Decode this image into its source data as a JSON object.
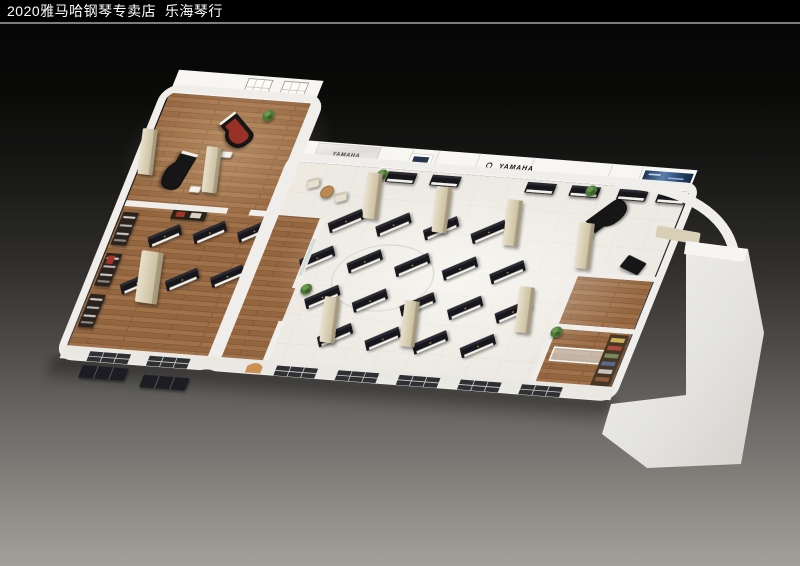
{
  "header": {
    "title": "2020雅马哈钢琴专卖店  乐海琴行"
  },
  "brand": {
    "wall_sign": "YAMAHA",
    "marble_sign": "YAMAHA"
  },
  "palette": {
    "titlebar_bg": "#000000",
    "titlebar_text": "#ffffff",
    "divider": "#7d7d7d",
    "bg_top": "#040404",
    "bg_bottom": "#a3a09b",
    "wall": "#efeeea",
    "wall_face": "#f7f6f3",
    "wood": "#9a6b42",
    "wood_dark": "#7a5433",
    "tile": "#edeae3",
    "piano_black": "#17171a",
    "keys_white": "#f2f1ea",
    "column_beige": "#d8cdb3",
    "glass": "#cfd8da",
    "window_dark": "#2e3034",
    "plant_green": "#4e7a3a",
    "marble": "#e9e8e5",
    "display_blue": "#35507c",
    "accent_red": "#a5342a",
    "exterior_mass": "#e9e8e5"
  },
  "scene": {
    "hall_uprights": [
      [
        262,
        66
      ],
      [
        318,
        66
      ],
      [
        374,
        66
      ],
      [
        430,
        66
      ],
      [
        246,
        112
      ],
      [
        302,
        112
      ],
      [
        358,
        112
      ],
      [
        414,
        112
      ],
      [
        470,
        112
      ],
      [
        270,
        158
      ],
      [
        326,
        158
      ],
      [
        382,
        158
      ],
      [
        438,
        158
      ],
      [
        494,
        158
      ],
      [
        302,
        202
      ],
      [
        358,
        202
      ],
      [
        414,
        202
      ],
      [
        470,
        202
      ]
    ],
    "hall_upright_rot": -32,
    "left_uprights": [
      [
        62,
        100
      ],
      [
        112,
        92
      ],
      [
        162,
        86
      ],
      [
        52,
        158
      ],
      [
        102,
        150
      ],
      [
        152,
        142
      ]
    ],
    "left_upright_rot": -32,
    "wall_pianos_x": [
      288,
      340,
      452,
      504,
      560,
      606
    ],
    "grand_pianos": [
      {
        "x": 95,
        "y": -28,
        "rot": 38,
        "red_interior": true
      },
      {
        "x": 45,
        "y": 22,
        "rot": 100,
        "red_interior": false
      },
      {
        "x": 560,
        "y": 38,
        "rot": -50,
        "red_interior": false
      }
    ],
    "benches": [
      [
        95,
        -2
      ],
      [
        75,
        42
      ],
      [
        544,
        62
      ]
    ],
    "lounge": {
      "chairs": [
        [
          207,
          24
        ],
        [
          245,
          38
        ]
      ],
      "table": [
        227,
        33
      ]
    },
    "plants": [
      [
        282,
        8
      ],
      [
        528,
        8
      ],
      [
        553,
        178
      ],
      [
        125,
        -52
      ],
      [
        248,
        150
      ]
    ],
    "columns_screen": [
      [
        368,
        172
      ],
      [
        437,
        186
      ],
      [
        508,
        199
      ],
      [
        325,
        296
      ],
      [
        405,
        300
      ],
      [
        520,
        286
      ],
      [
        143,
        128
      ],
      [
        207,
        146
      ],
      [
        580,
        222
      ]
    ],
    "kiosk_screen": [
      142,
      250
    ],
    "front_windows_x": [
      30,
      100,
      250,
      322,
      394,
      466,
      538
    ],
    "facade_frames": [
      [
        28,
        260
      ],
      [
        102,
        266
      ]
    ],
    "back_windows_x": [
      86,
      128
    ],
    "left_shelves_y": [
      75,
      125,
      175
    ],
    "marble_panel": {
      "x": 196,
      "y": -24,
      "w": 72,
      "h": 22
    },
    "wall_sign_pos": [
      424,
      -10.5
    ],
    "picture_frame": {
      "x": 306,
      "y": -20,
      "w": 26,
      "h": 14
    },
    "blue_display": {
      "x": 580,
      "y": -22,
      "w": 58,
      "h": 16
    },
    "rooms": {
      "floors": [
        [
          552,
          110,
          88,
          58
        ],
        [
          552,
          174,
          88,
          66
        ]
      ],
      "walls": [
        [
          546,
          104,
          96,
          6
        ],
        [
          546,
          104,
          6,
          136
        ],
        [
          546,
          168,
          96,
          6
        ]
      ],
      "glass_counter": [
        558,
        196,
        70,
        16
      ],
      "bookshelf": [
        616,
        176,
        22,
        62
      ]
    },
    "dark_wedge": {
      "x": 610,
      "y": 92,
      "rot": 20
    },
    "matrix": [
      0.85,
      0.065,
      -0.33,
      0.82,
      145,
      150
    ]
  }
}
